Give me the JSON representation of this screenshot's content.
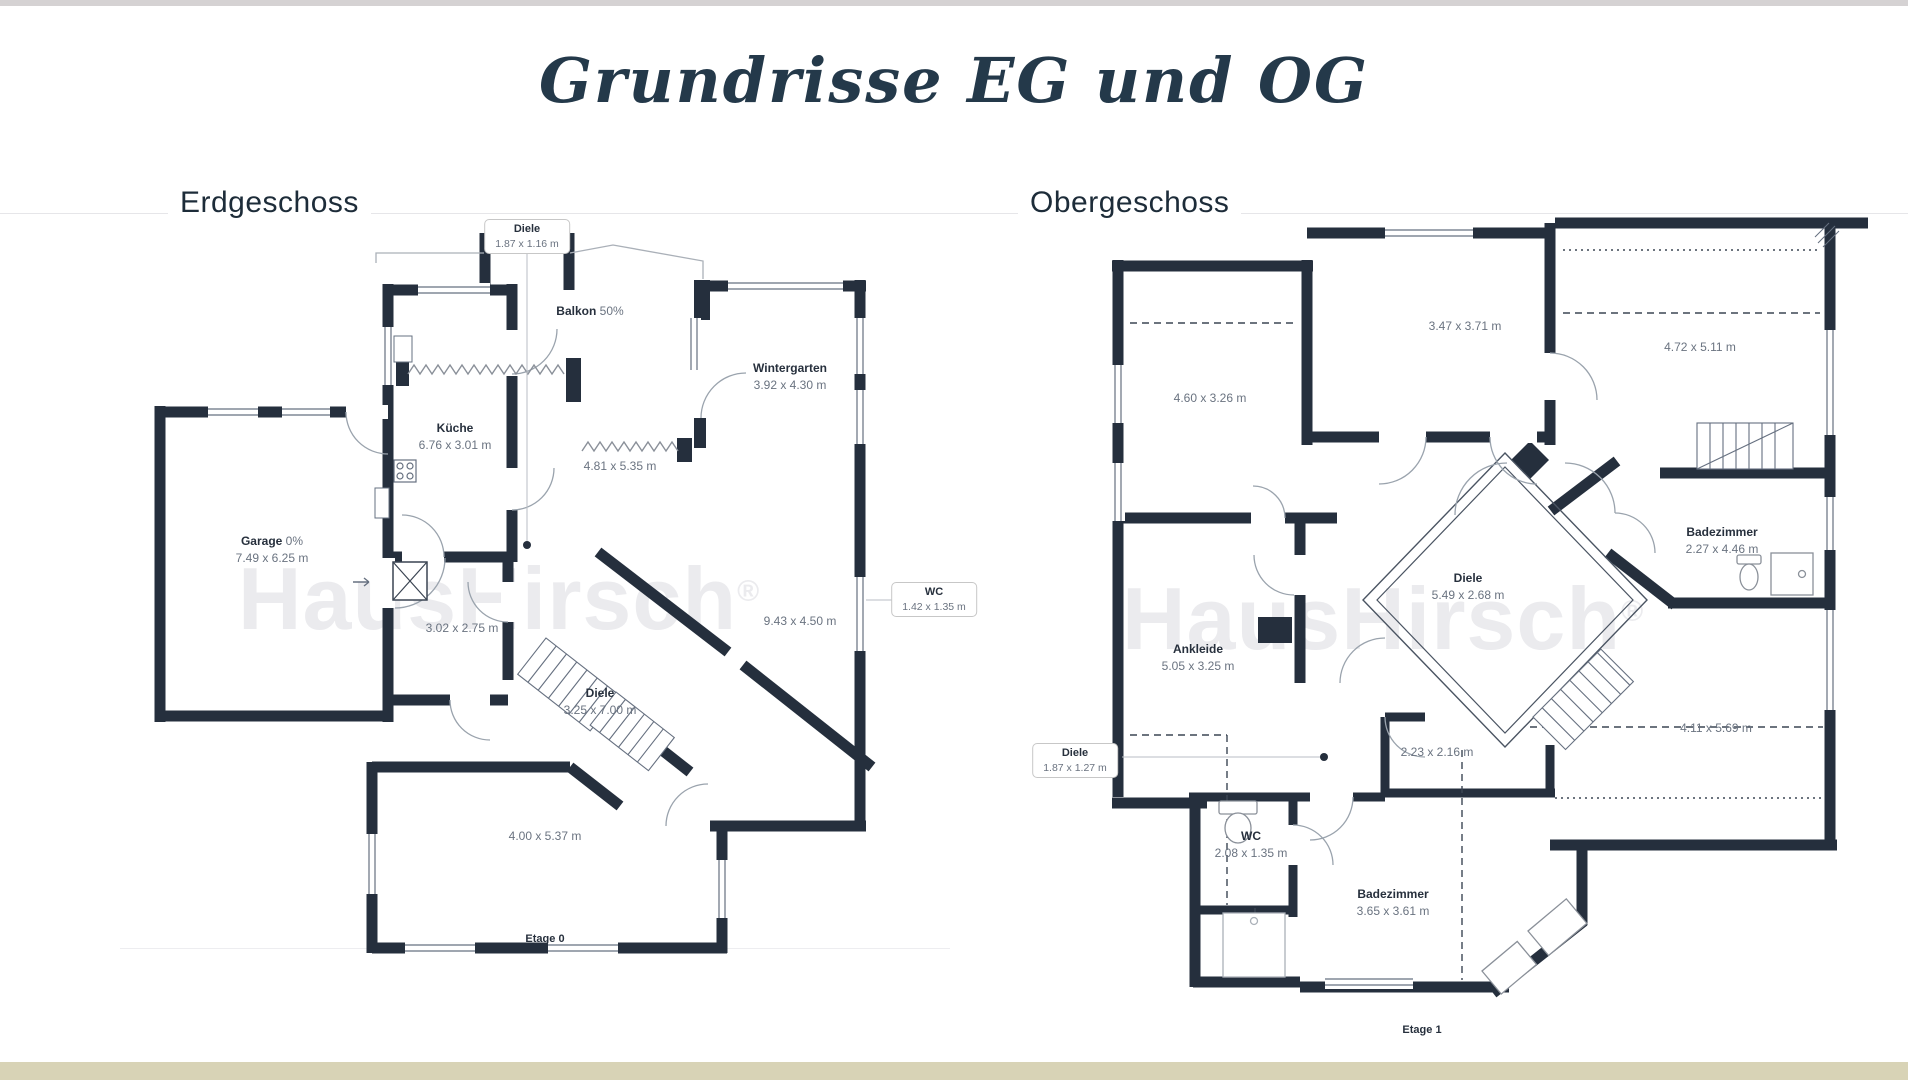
{
  "title": "Grundrisse EG und OG",
  "watermark": {
    "text": "HausHirsch",
    "reg": "®"
  },
  "colors": {
    "wall": "#252f3d",
    "title_navy": "#24394a",
    "top_bar": "#d5d2d3",
    "bottom_bar": "#d8d3b6",
    "watermark_gray": "#ebebee"
  },
  "eg": {
    "heading": "Erdgeschoss",
    "floor_label": "Etage 0",
    "callout_top": {
      "name": "Diele",
      "dims": "1.87 x 1.16 m"
    },
    "callout_wc": {
      "name": "WC",
      "dims": "1.42 x 1.35 m"
    },
    "balkon": {
      "name": "Balkon",
      "note": "50%"
    },
    "wintergarten": {
      "name": "Wintergarten",
      "dims": "3.92 x 4.30 m"
    },
    "kueche": {
      "name": "Küche",
      "dims": "6.76 x 3.01 m"
    },
    "wohnbereich": {
      "dims": "4.81 x 5.35 m"
    },
    "garage": {
      "name": "Garage",
      "note": "0%",
      "dims": "7.49 x 6.25 m"
    },
    "room_302": {
      "dims": "3.02 x 2.75 m"
    },
    "room_943": {
      "dims": "9.43 x 4.50 m"
    },
    "diele": {
      "name": "Diele",
      "dims": "3.25 x 7.00 m"
    },
    "room_400": {
      "dims": "4.00 x 5.37 m"
    }
  },
  "og": {
    "heading": "Obergeschoss",
    "floor_label": "Etage 1",
    "callout_diele": {
      "name": "Diele",
      "dims": "1.87 x 1.27 m"
    },
    "room_347": {
      "dims": "3.47 x 3.71 m"
    },
    "room_460": {
      "dims": "4.60 x 3.26 m"
    },
    "room_472": {
      "dims": "4.72 x 5.11 m"
    },
    "bad_oben": {
      "name": "Badezimmer",
      "dims": "2.27 x 4.46 m"
    },
    "diele": {
      "name": "Diele",
      "dims": "5.49 x 2.68 m"
    },
    "ankleide": {
      "name": "Ankleide",
      "dims": "5.05 x 3.25 m"
    },
    "room_223": {
      "dims": "2.23 x 2.16 m"
    },
    "room_411": {
      "dims": "4.11 x 5.69 m"
    },
    "wc": {
      "name": "WC",
      "dims": "2.08 x 1.35 m"
    },
    "bad_unten": {
      "name": "Badezimmer",
      "dims": "3.65 x 3.61 m"
    }
  }
}
